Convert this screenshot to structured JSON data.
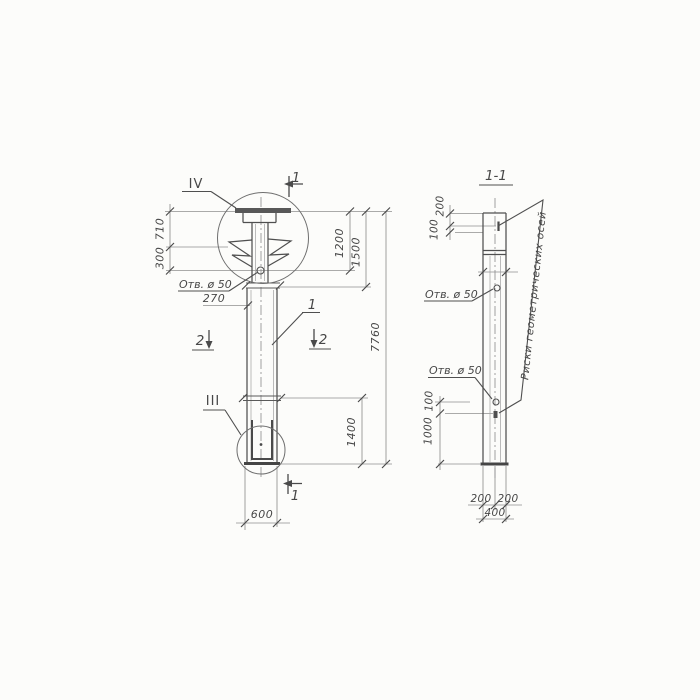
{
  "drawing": {
    "type": "engineering-column-drawing",
    "ink_color": "#4f4f4f",
    "light_line_color": "#8f8f8f",
    "paper_color": "#fcfcfa"
  },
  "elevation": {
    "detail_top": "IV",
    "detail_bottom": "III",
    "part_label": "1",
    "hole_label": "Отв. ø 50",
    "section_cut_top": "1",
    "section_cut_bottom": "1",
    "section_cut_left": "2",
    "section_cut_right": "2",
    "dim_710": "710",
    "dim_300": "300",
    "dim_270": "270",
    "dim_1200": "1200",
    "dim_1500": "1500",
    "dim_7760": "7760",
    "dim_1400": "1400",
    "dim_600": "600"
  },
  "section_view": {
    "title": "1-1",
    "hole_label_upper": "Отв. ø 50",
    "hole_label_lower": "Отв. ø 50",
    "axes_note": "Риски геометрических осей",
    "dim_200_top": "200",
    "dim_100_top": "100",
    "dim_100_lower": "100",
    "dim_1000": "1000",
    "dim_200_left": "200",
    "dim_200_right": "200",
    "dim_400": "400"
  }
}
